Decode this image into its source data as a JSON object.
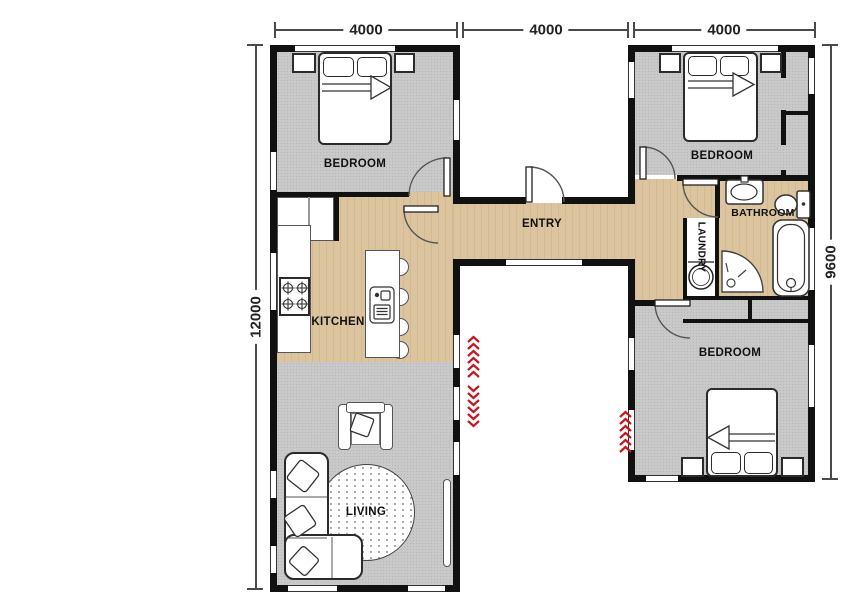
{
  "dimensions": {
    "top_left": "4000",
    "top_middle": "4000",
    "top_right": "4000",
    "side_left": "12000",
    "side_right": "9600"
  },
  "rooms": {
    "bedroom_top_left": {
      "label": "BEDROOM"
    },
    "bedroom_top_right": {
      "label": "BEDROOM"
    },
    "bedroom_bottom_right": {
      "label": "BEDROOM"
    },
    "entry": {
      "label": "ENTRY"
    },
    "kitchen": {
      "label": "KITCHEN"
    },
    "bathroom": {
      "label": "BATHROOM"
    },
    "laundry": {
      "label": "LAUNDRY"
    },
    "living": {
      "label": "LIVING"
    }
  },
  "colors": {
    "wall": "#111111",
    "carpet": "#c9c9c9",
    "timber": "#dbc49e",
    "accent_red": "#c8161d"
  }
}
